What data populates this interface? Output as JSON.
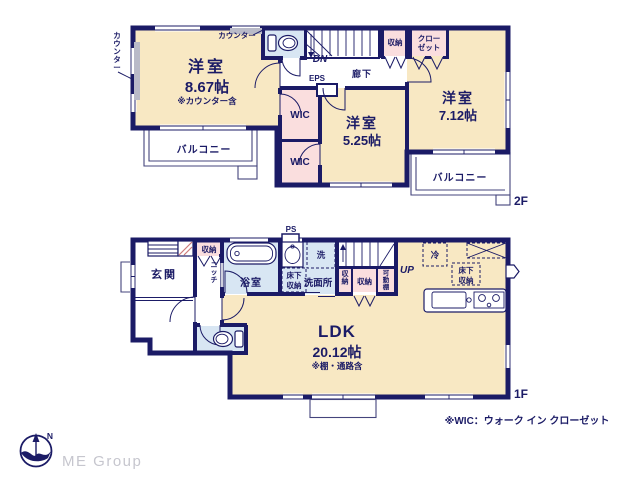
{
  "colors": {
    "wall_navy": "#1b1b66",
    "room_cream": "#f8e8c3",
    "storage_pink": "#fadede",
    "wet_blue": "#d8e6f3",
    "text_navy": "#1b1b66",
    "logo_gray": "#c6c6ce",
    "counter_gray": "#b9bac8"
  },
  "floor2": {
    "label": "2F",
    "room_867": {
      "name": "洋室",
      "size": "8.67帖",
      "note": "※カウンター含"
    },
    "counter_top": "カウンター",
    "counter_left": "カウンター",
    "balcony_left": "バルコニー",
    "balcony_right": "バルコニー",
    "wic_upper": "WIC",
    "wic_lower": "WIC",
    "room_525": {
      "name": "洋室",
      "size": "5.25帖"
    },
    "room_712": {
      "name": "洋室",
      "size": "7.12帖"
    },
    "corridor": "廊下",
    "stairs_down": "DN",
    "eps": "EPS",
    "storage": "収納",
    "closet": [
      "クロー",
      "ゼット"
    ]
  },
  "floor1": {
    "label": "1F",
    "entrance": "玄関",
    "entrance_storage": "収納",
    "niche": "ニッチ",
    "bathroom": "浴室",
    "ps": "PS",
    "washer": "洗",
    "washroom": "洗面所",
    "underfloor_storage_wash": [
      "床下",
      "収納"
    ],
    "storage_narrow": "収納",
    "storage_wide": "収納",
    "movable_shelf": "可動棚",
    "stairs_up": "UP",
    "fridge": "冷",
    "underfloor_storage_kitchen": [
      "床下",
      "収納"
    ],
    "ldk": {
      "name": "LDK",
      "size": "20.12帖",
      "note": "※棚・通路含"
    }
  },
  "footer": {
    "wic_note": "※WIC：ウォーク イン クローゼット",
    "logo": "ME Group",
    "compass_north": "N"
  }
}
